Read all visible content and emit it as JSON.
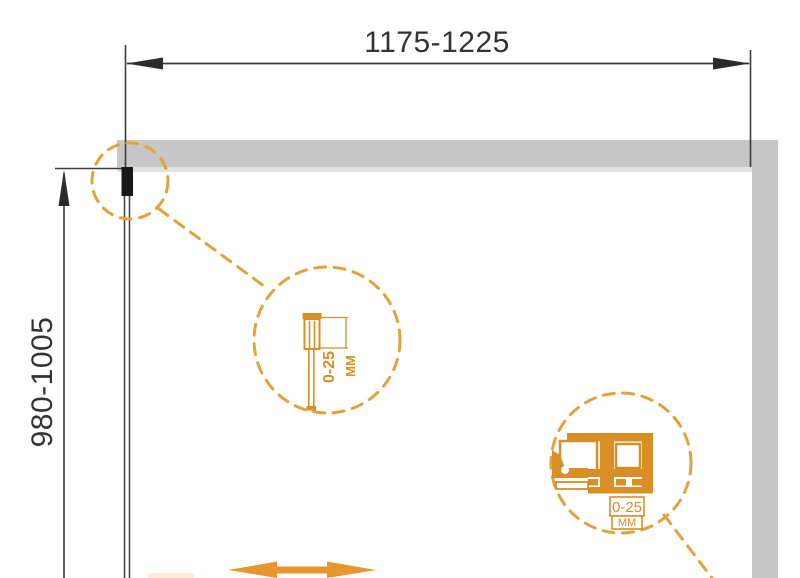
{
  "drawing": {
    "type": "shower-enclosure-dimension-diagram",
    "width_dimension": {
      "label": "1175-1225"
    },
    "height_dimension": {
      "label": "980-1005"
    },
    "detail_wall_profile": {
      "range": "0-25",
      "unit": "MM"
    },
    "detail_roller": {
      "range": "0-25",
      "unit": "MM"
    },
    "colors": {
      "wall_gray": "#c7c7c7",
      "line_dark": "#3c3c3c",
      "profile_black": "#181818",
      "dash_orange": "#e2a23c",
      "detail_orange": "#d98f26",
      "arrow_orange": "#e8962e"
    }
  }
}
